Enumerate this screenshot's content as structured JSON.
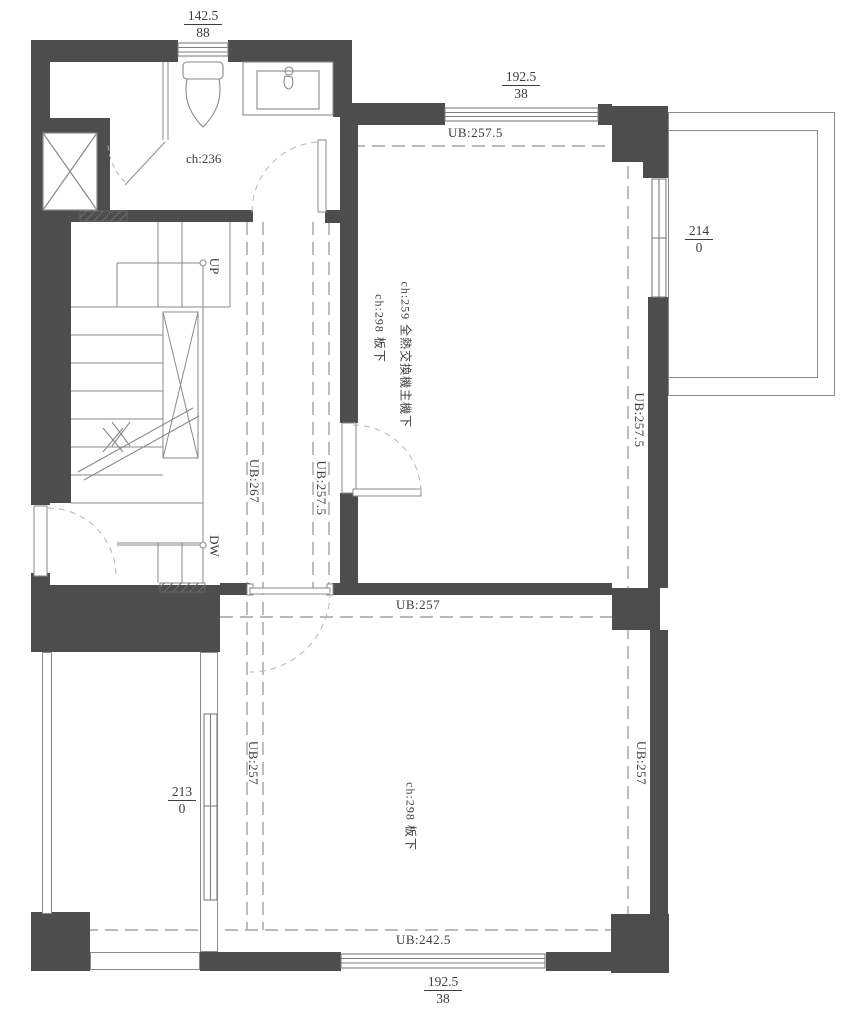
{
  "plan_title": "floor-plan",
  "dimensions": {
    "top": {
      "value": "142.5",
      "sub": "88"
    },
    "top_right": {
      "value": "192.5",
      "sub": "38"
    },
    "right": {
      "value": "214",
      "sub": "0"
    },
    "left_bottom": {
      "value": "213",
      "sub": "0"
    },
    "bottom": {
      "value": "192.5",
      "sub": "38"
    }
  },
  "beam_labels": {
    "top": "UB:257.5",
    "hall_left": "UB:267",
    "hall_right": "UB:257.5",
    "right_upper": "UB:257.5",
    "middle": "UB:257",
    "bottom_left": "UB:257",
    "bottom_right": "UB:257",
    "bottom": "UB:242.5"
  },
  "rooms": {
    "bathroom_height": "ch:236",
    "mech_room_line1": "ch:259 全熱交換機主機下",
    "mech_room_line2": "ch:298 板下",
    "lower_room_height": "ch:298 板下"
  },
  "stairs": {
    "up": "UP",
    "down": "DW"
  },
  "colors": {
    "wall": "#4d4d4d",
    "line": "#8a8a8a",
    "dash": "#a3a3a3",
    "text": "#3d3d3d"
  }
}
